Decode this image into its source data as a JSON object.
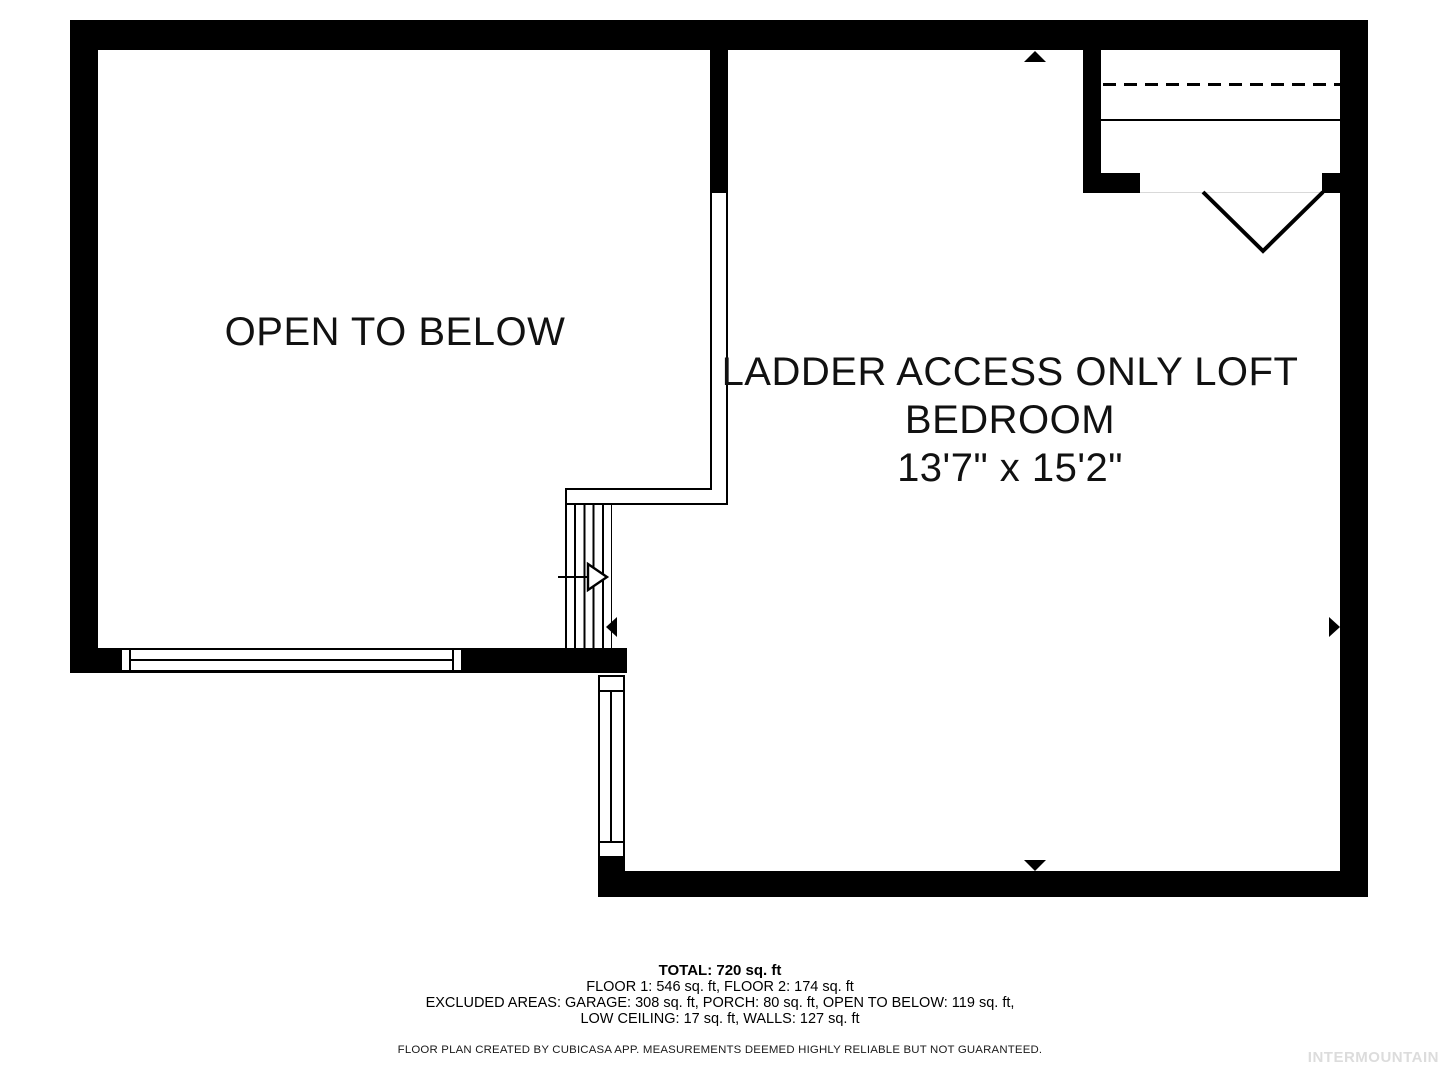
{
  "rooms": {
    "open_to_below": {
      "label": "OPEN TO BELOW"
    },
    "loft": {
      "label_line1": "LADDER ACCESS ONLY LOFT",
      "label_line2": "BEDROOM",
      "dimensions": "13'7\" x 15'2\""
    }
  },
  "summary": {
    "total": "TOTAL: 720 sq. ft",
    "floors": "FLOOR 1: 546 sq. ft, FLOOR 2: 174 sq. ft",
    "excluded_line1": "EXCLUDED AREAS: GARAGE: 308 sq. ft, PORCH: 80 sq. ft, OPEN TO BELOW: 119 sq. ft,",
    "excluded_line2": "LOW CEILING: 17 sq. ft, WALLS: 127 sq. ft",
    "disclaimer": "FLOOR PLAN CREATED BY CUBICASA APP. MEASUREMENTS DEEMED HIGHLY RELIABLE BUT NOT GUARANTEED."
  },
  "watermark": "INTERMOUNTAIN",
  "colors": {
    "wall": "#000000",
    "background": "#ffffff",
    "watermark_gray": "#dcdcdc"
  }
}
